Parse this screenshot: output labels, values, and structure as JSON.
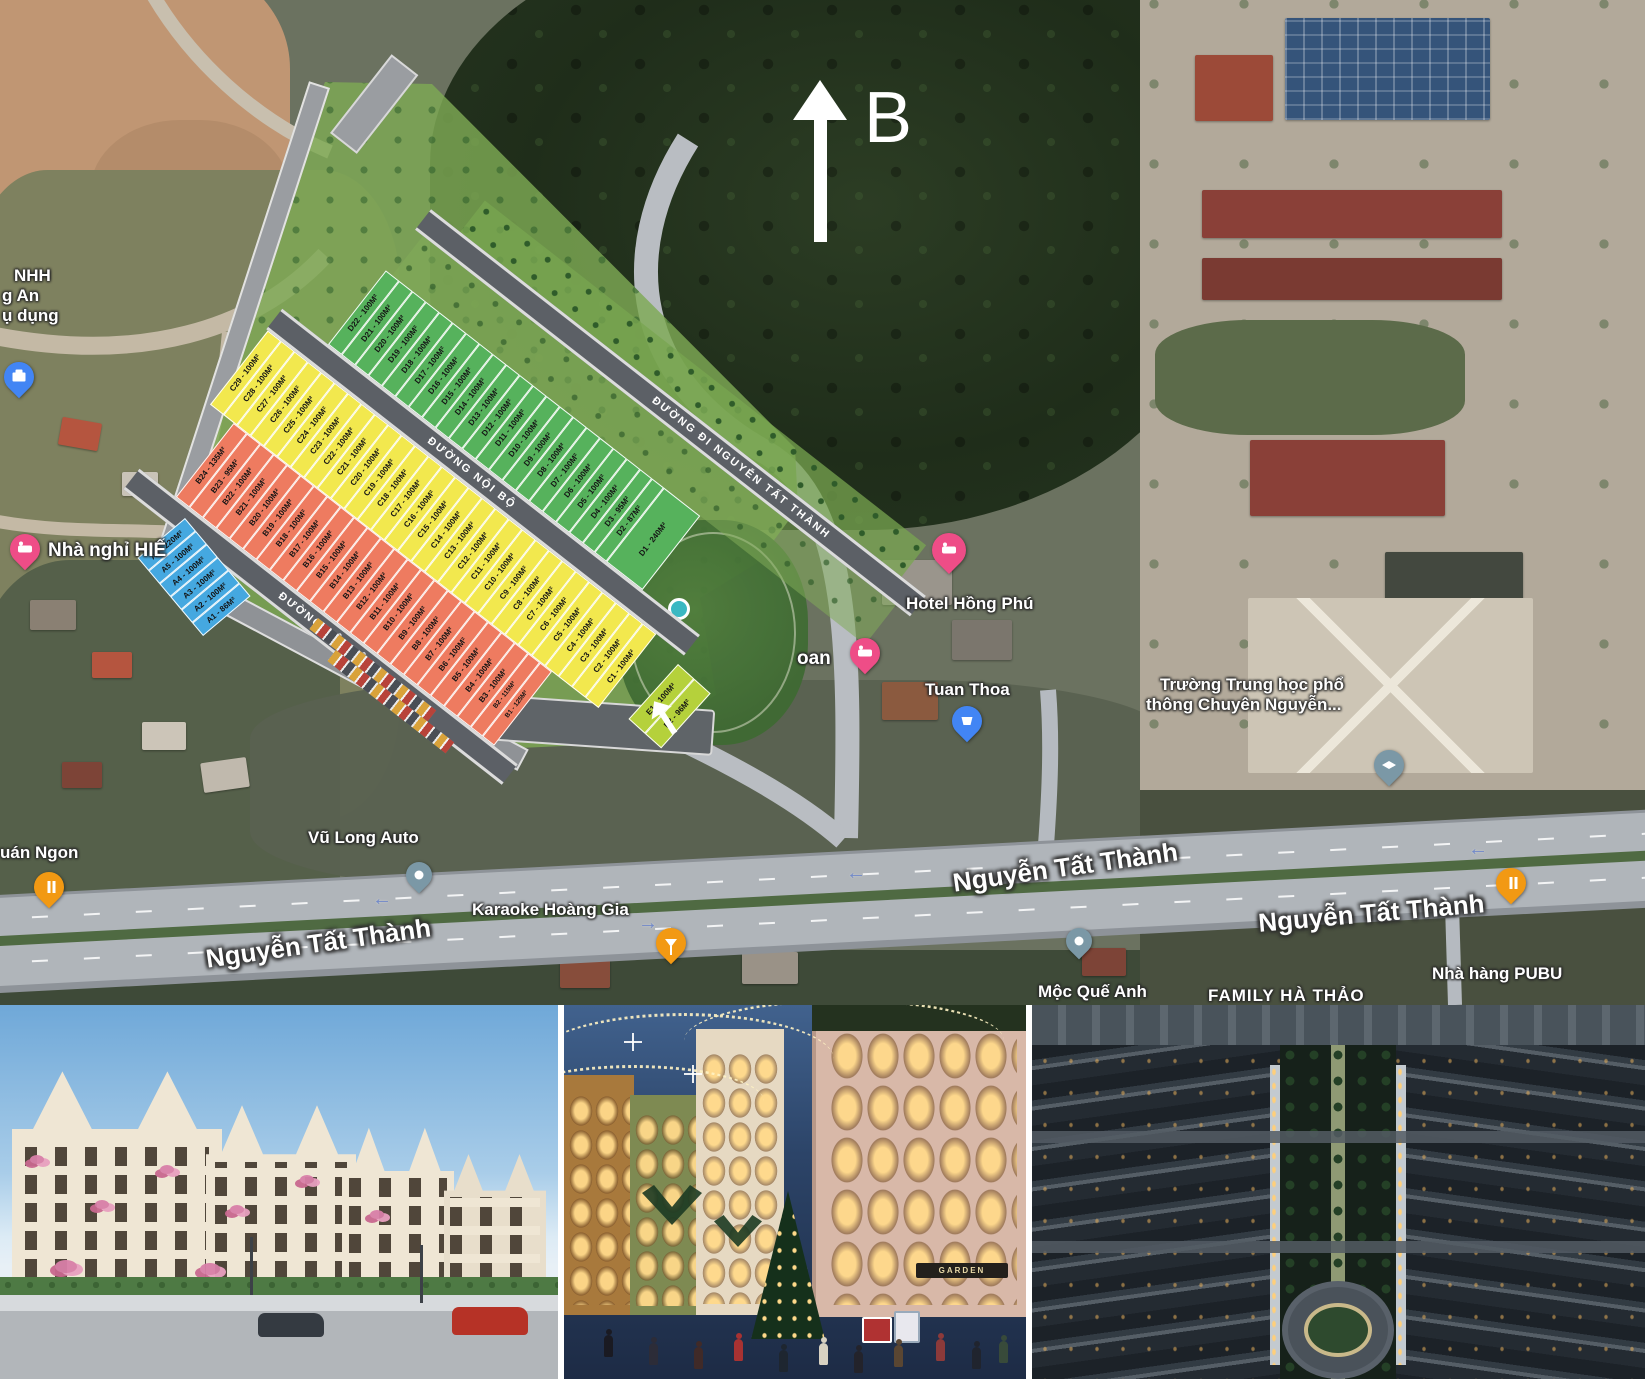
{
  "compass": {
    "north_label": "B"
  },
  "site_plan": {
    "road_labels": {
      "perimeter": "ĐƯỜNG ĐI NGUYỄN TẤT THÀNH",
      "internal_upper": "ĐƯỜNG NỘI BỘ",
      "internal_lower": "ĐƯỜNG NỘI BỘ"
    },
    "rows": {
      "d": [
        "D22 - 100M²",
        "D21 - 100M²",
        "D20 - 100M²",
        "D19 - 100M²",
        "D18 - 100M²",
        "D17 - 100M²",
        "D16 - 100M²",
        "D15 - 100M²",
        "D14 - 100M²",
        "D13 - 100M²",
        "D12 - 100M²",
        "D11 - 100M²",
        "D10 - 100M²",
        "D9 - 100M²",
        "D8 - 100M²",
        "D7 - 100M²",
        "D6 - 100M²",
        "D5 - 100M²",
        "D4 - 100M²",
        "D3 - 95M²",
        "D2 - 87M²",
        "D1 - 240M²"
      ],
      "c": [
        "C29 - 100M²",
        "C28 - 100M²",
        "C27 - 100M²",
        "C26 - 100M²",
        "C25 - 100M²",
        "C24 - 100M²",
        "C23 - 100M²",
        "C22 - 100M²",
        "C21 - 100M²",
        "C20 - 100M²",
        "C19 - 100M²",
        "C18 - 100M²",
        "C17 - 100M²",
        "C16 - 100M²",
        "C15 - 100M²",
        "C14 - 100M²",
        "C13 - 100M²",
        "C12 - 100M²",
        "C11 - 100M²",
        "C10 - 100M²",
        "C9 - 100M²",
        "C8 - 100M²",
        "C7 - 100M²",
        "C6 - 100M²",
        "C5 - 100M²",
        "C4 - 100M²",
        "C3 - 100M²",
        "C2 - 100M²",
        "C1 - 100M²"
      ],
      "b": [
        "B24 - 135M²",
        "B23 - 95M²",
        "B22 - 100M²",
        "B21 - 100M²",
        "B20 - 100M²",
        "B19 - 100M²",
        "B18 - 100M²",
        "B17 - 100M²",
        "B16 - 100M²",
        "B15 - 100M²",
        "B14 - 100M²",
        "B13 - 100M²",
        "B12 - 100M²",
        "B11 - 100M²",
        "B10 - 100M²",
        "B9 - 100M²",
        "B8 - 100M²",
        "B7 - 100M²",
        "B6 - 100M²",
        "B5 - 100M²",
        "B4 - 100M²",
        "B3 - 100M²",
        "B2 - 115M²",
        "B1 - 125M²"
      ],
      "a": [
        "A6 - 220M²",
        "A5 - 100M²",
        "A4 - 100M²",
        "A3 - 100M²",
        "A2 - 100M²",
        "A1 - 86M²"
      ],
      "e": [
        "E1 - 100M²",
        "E2 - 96M²"
      ]
    }
  },
  "map": {
    "road_labels": {
      "left": "Nguyễn Tất Thành",
      "center": "Nguyễn Tất Thành",
      "right": "Nguyễn Tất Thành"
    },
    "pois": {
      "credit_office": {
        "lines": [
          "NHH",
          "g An",
          "ụ dụng"
        ]
      },
      "guesthouse": {
        "label": "Nhà nghỉ HIẾ"
      },
      "hotel_oan": {
        "label": "oan"
      },
      "hotel_hong_phu": {
        "label": "Hotel Hồng Phú"
      },
      "tuan_thoa": {
        "label": "Tuan Thoa"
      },
      "school": {
        "line1": "Trường Trung học phổ",
        "line2": "thông Chuyên Nguyễn..."
      },
      "quan_ngon": {
        "label": "uán Ngon"
      },
      "vu_long_auto": {
        "label": "Vũ Long Auto"
      },
      "karaoke": {
        "label": "Karaoke Hoàng Gia"
      },
      "moc_que_anh": {
        "label": "Mộc Quế Anh"
      },
      "pubu": {
        "label": "Nhà hàng PUBU"
      },
      "family_ha_thao": {
        "label": "FAMILY HÀ THẢO"
      }
    }
  },
  "photos": {
    "night_street": {
      "storefront_sign": "GARDEN"
    }
  }
}
